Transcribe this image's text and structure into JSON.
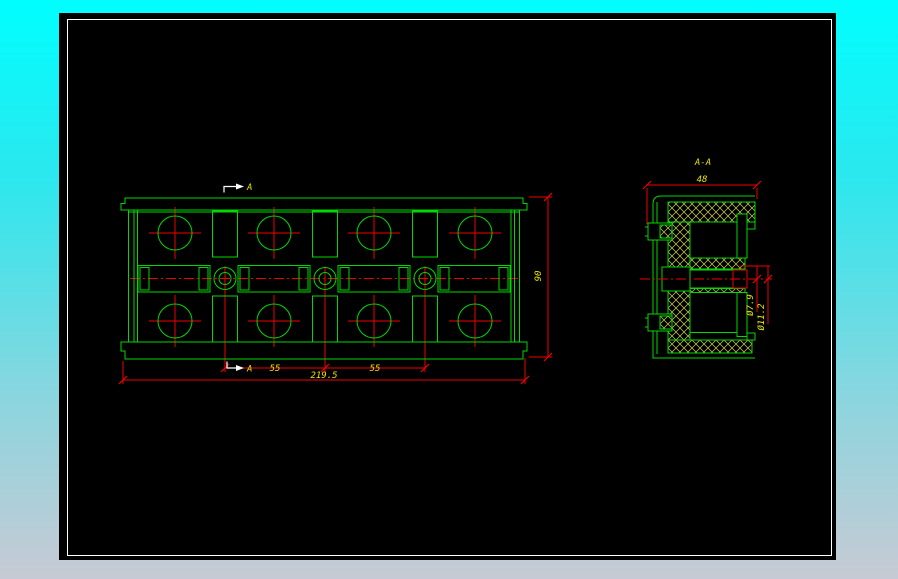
{
  "colors": {
    "background_top": "#00feff",
    "background_bottom": "#c7cad4",
    "canvas": "#000000",
    "frame": "#ffffff",
    "geometry": "#00d800",
    "dimension_lines": "#ee0000",
    "dimension_text": "#e8e400",
    "hatch": "#cfcf55",
    "section_marker": "#ffffff"
  },
  "front_view": {
    "section_marker_top": "A",
    "section_marker_bottom": "A",
    "dim_pitch_1": "55",
    "dim_pitch_2": "55",
    "dim_overall_width": "219.5",
    "dim_overall_height": "90"
  },
  "section_view": {
    "label": "A-A",
    "dim_width": "48",
    "dim_inner_dia": "Ø7.9",
    "dim_outer_dia": "Ø11.2"
  }
}
